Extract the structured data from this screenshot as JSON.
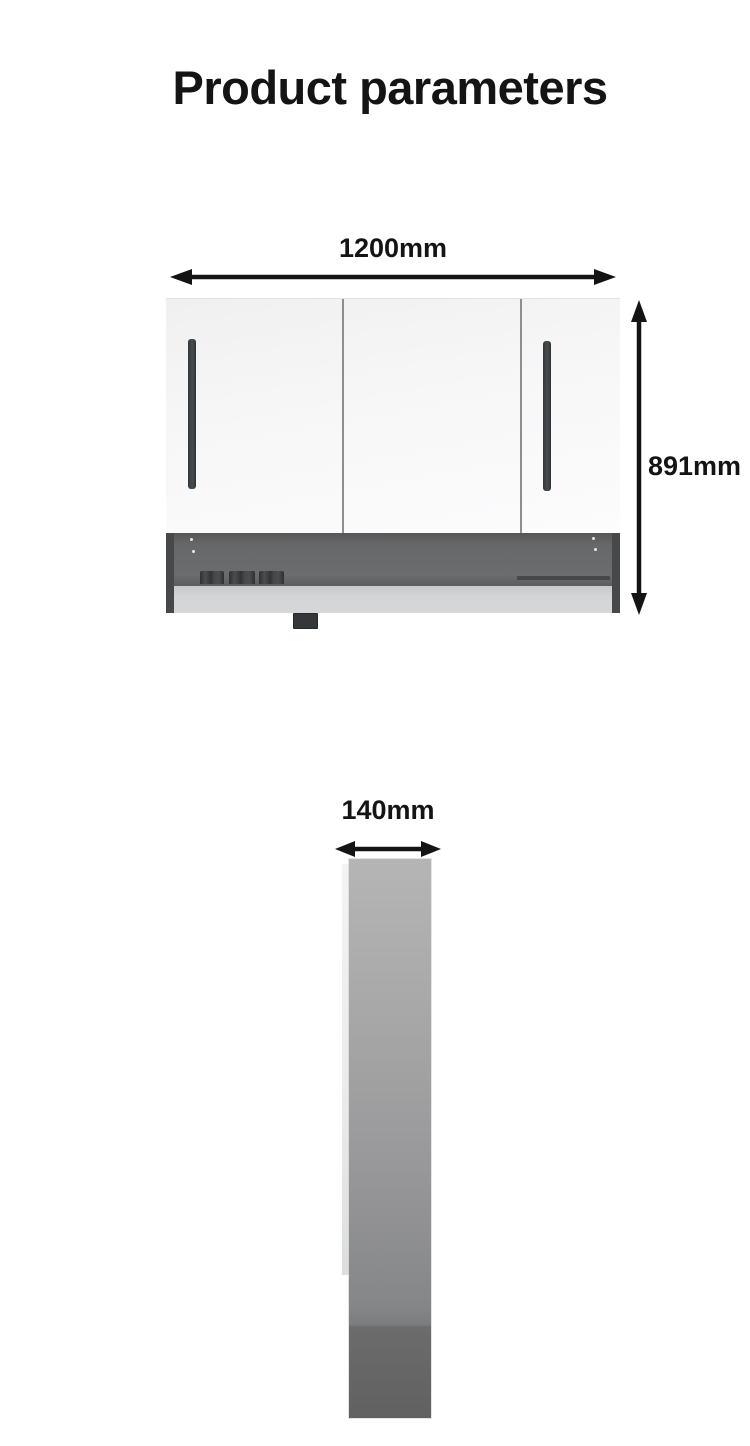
{
  "title": "Product parameters",
  "front_view": {
    "name": "mirror cabinet front view",
    "width_label": "1200mm",
    "height_label": "891mm"
  },
  "side_view": {
    "name": "mirror cabinet side view",
    "depth_label": "140mm"
  },
  "colors": {
    "text": "#141414",
    "arrow": "#141414",
    "door_white": "#f6f6f7",
    "divider_gray": "#8d8e8f",
    "cabinet_wall_dark": "#46484a",
    "recess_gray": "#68696b",
    "shelf_light": "#d2d3d4",
    "handle_dark": "#3e4144",
    "side_panel_gray": "#9a9a9b",
    "side_panel_dark": "#676768"
  }
}
